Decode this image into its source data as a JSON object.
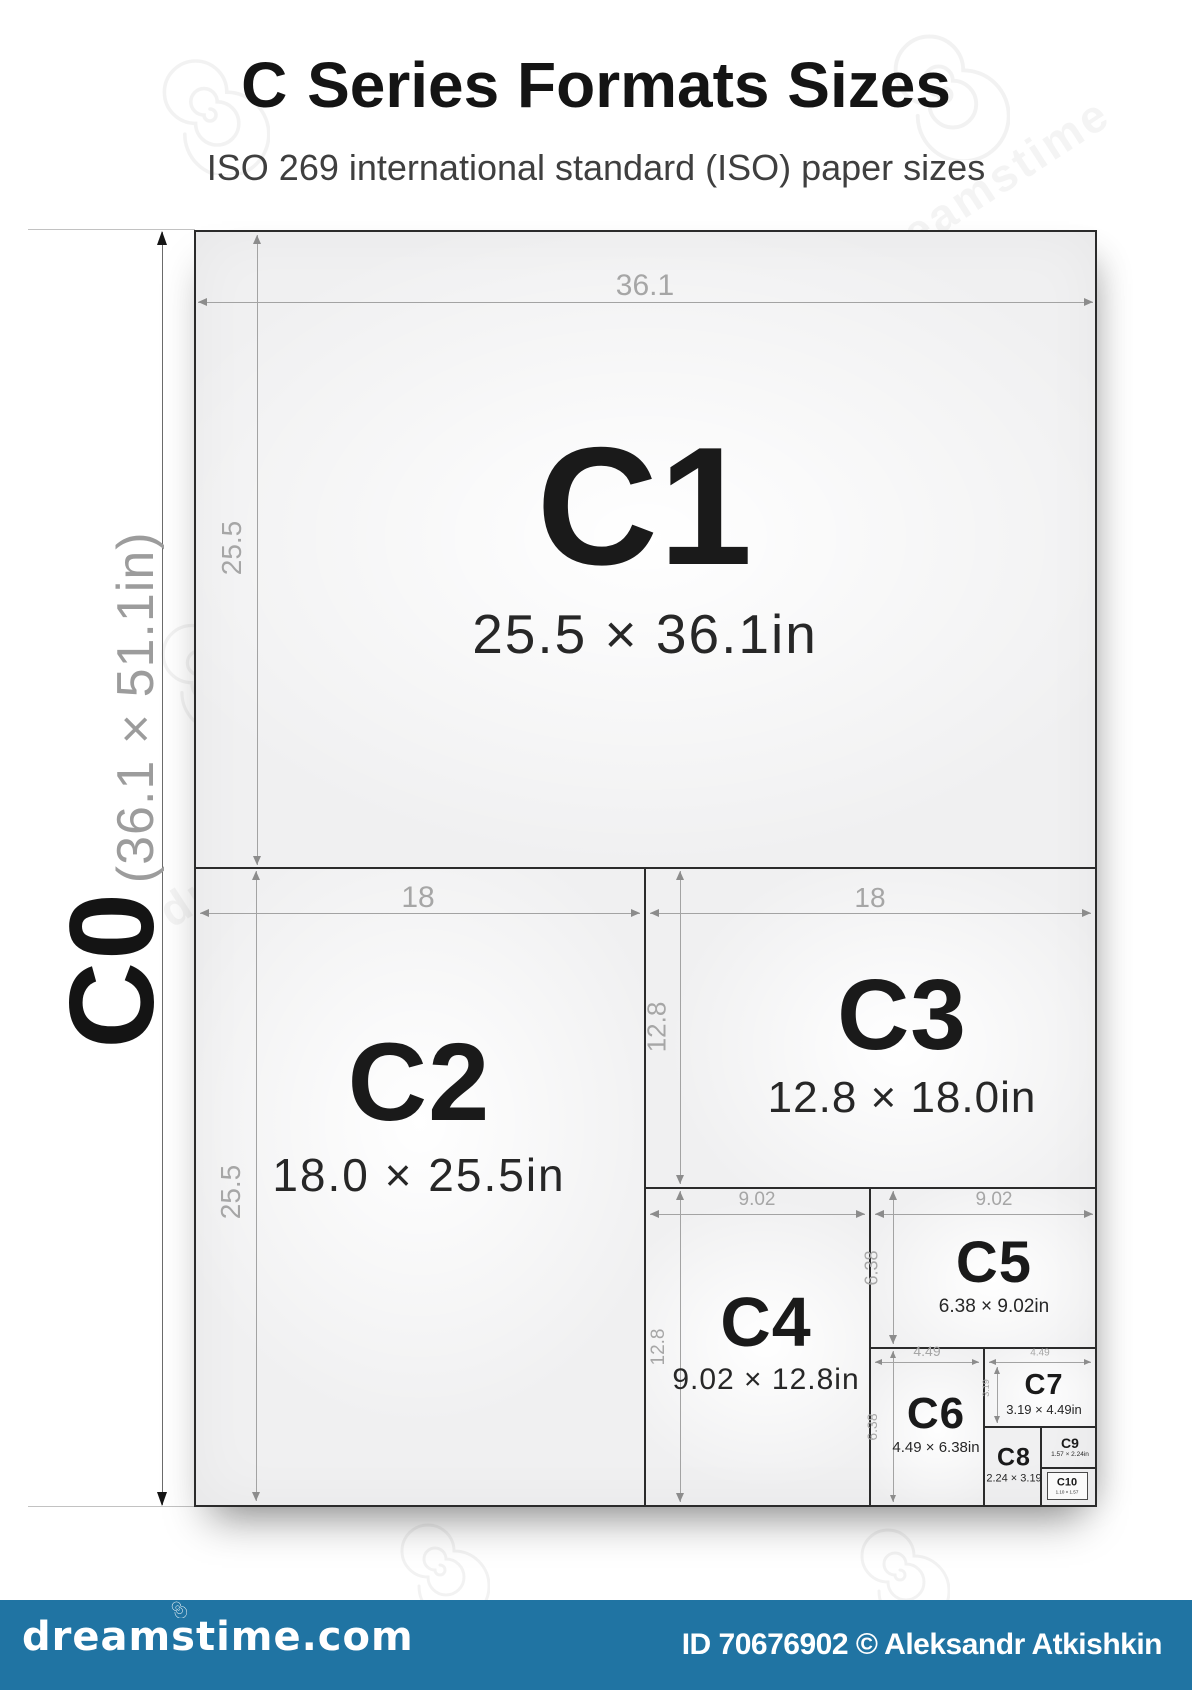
{
  "header": {
    "title_bold": "C",
    "title_rest": " Series Formats Sizes",
    "subtitle": "ISO 269 international standard (ISO) paper sizes"
  },
  "c0": {
    "label": "C0",
    "dimensions": "(36.1 × 51.1in)"
  },
  "formats": [
    {
      "name": "C1",
      "size": "25.5 × 36.1in",
      "width_label": "36.1",
      "height_label": "25.5"
    },
    {
      "name": "C2",
      "size": "18.0 × 25.5in",
      "width_label": "18",
      "height_label": "25.5"
    },
    {
      "name": "C3",
      "size": "12.8 × 18.0in",
      "width_label": "18",
      "height_label": "12.8"
    },
    {
      "name": "C4",
      "size": "9.02 × 12.8in",
      "width_label": "9.02",
      "height_label": "12.8"
    },
    {
      "name": "C5",
      "size": "6.38 × 9.02in",
      "width_label": "9.02",
      "height_label": "6.38"
    },
    {
      "name": "C6",
      "size": "4.49 × 6.38in",
      "width_label": "4.49",
      "height_label": "6.38"
    },
    {
      "name": "C7",
      "size": "3.19 × 4.49in",
      "width_label": "4.49",
      "height_label": "3.19"
    },
    {
      "name": "C8",
      "size": "2.24 × 3.19"
    },
    {
      "name": "C9",
      "size": "1.57 × 2.24in"
    },
    {
      "name": "C10",
      "size": "1.10 × 1.57"
    }
  ],
  "watermark": {
    "word": "dreamstime"
  },
  "footer": {
    "brand": "dreamstime.com",
    "credit": "ID 70676902 © Aleksandr Atkishkin"
  },
  "colors": {
    "footer_bar": "#2074a3",
    "paper": "#f0f0f1",
    "border": "#2b2b2b",
    "dim_line": "#a3a3a3"
  }
}
